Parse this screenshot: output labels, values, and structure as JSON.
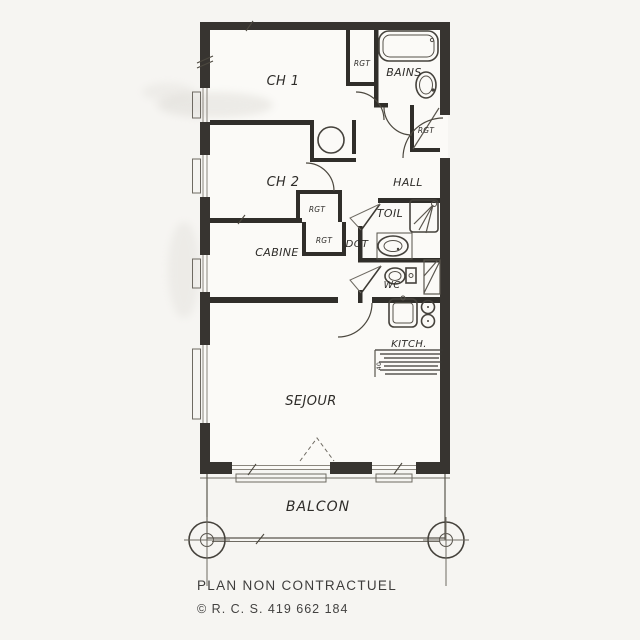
{
  "floorplan": {
    "labels": {
      "ch1": "CH 1",
      "ch2": "CH 2",
      "bains": "BAINS",
      "hall": "HALL",
      "toil": "TOIL",
      "dgt": "DGT",
      "cabine": "CABINE",
      "wc": "WC",
      "kitch": "KITCH.",
      "sejour": "SEJOUR",
      "balcon": "BALCON",
      "rgt_ch1": "RGT",
      "rgt_hall": "RGT",
      "rgt_ch2": "RGT",
      "rgt_dgt": "RGT",
      "kitchen_dim": "40"
    },
    "fixtures": [
      "bathtub",
      "bathroom-sink",
      "shower",
      "washbasin",
      "toilet",
      "kitchen-sink",
      "cooktop-burners",
      "cabinet-basin",
      "balcony-post"
    ],
    "colors": {
      "wall": "#373430",
      "paper": "#f6f5f2",
      "ink": "#2e2c29"
    }
  },
  "footer": {
    "disclaimer": "PLAN NON CONTRACTUEL",
    "registration": "© R. C. S. 419 662 184"
  }
}
